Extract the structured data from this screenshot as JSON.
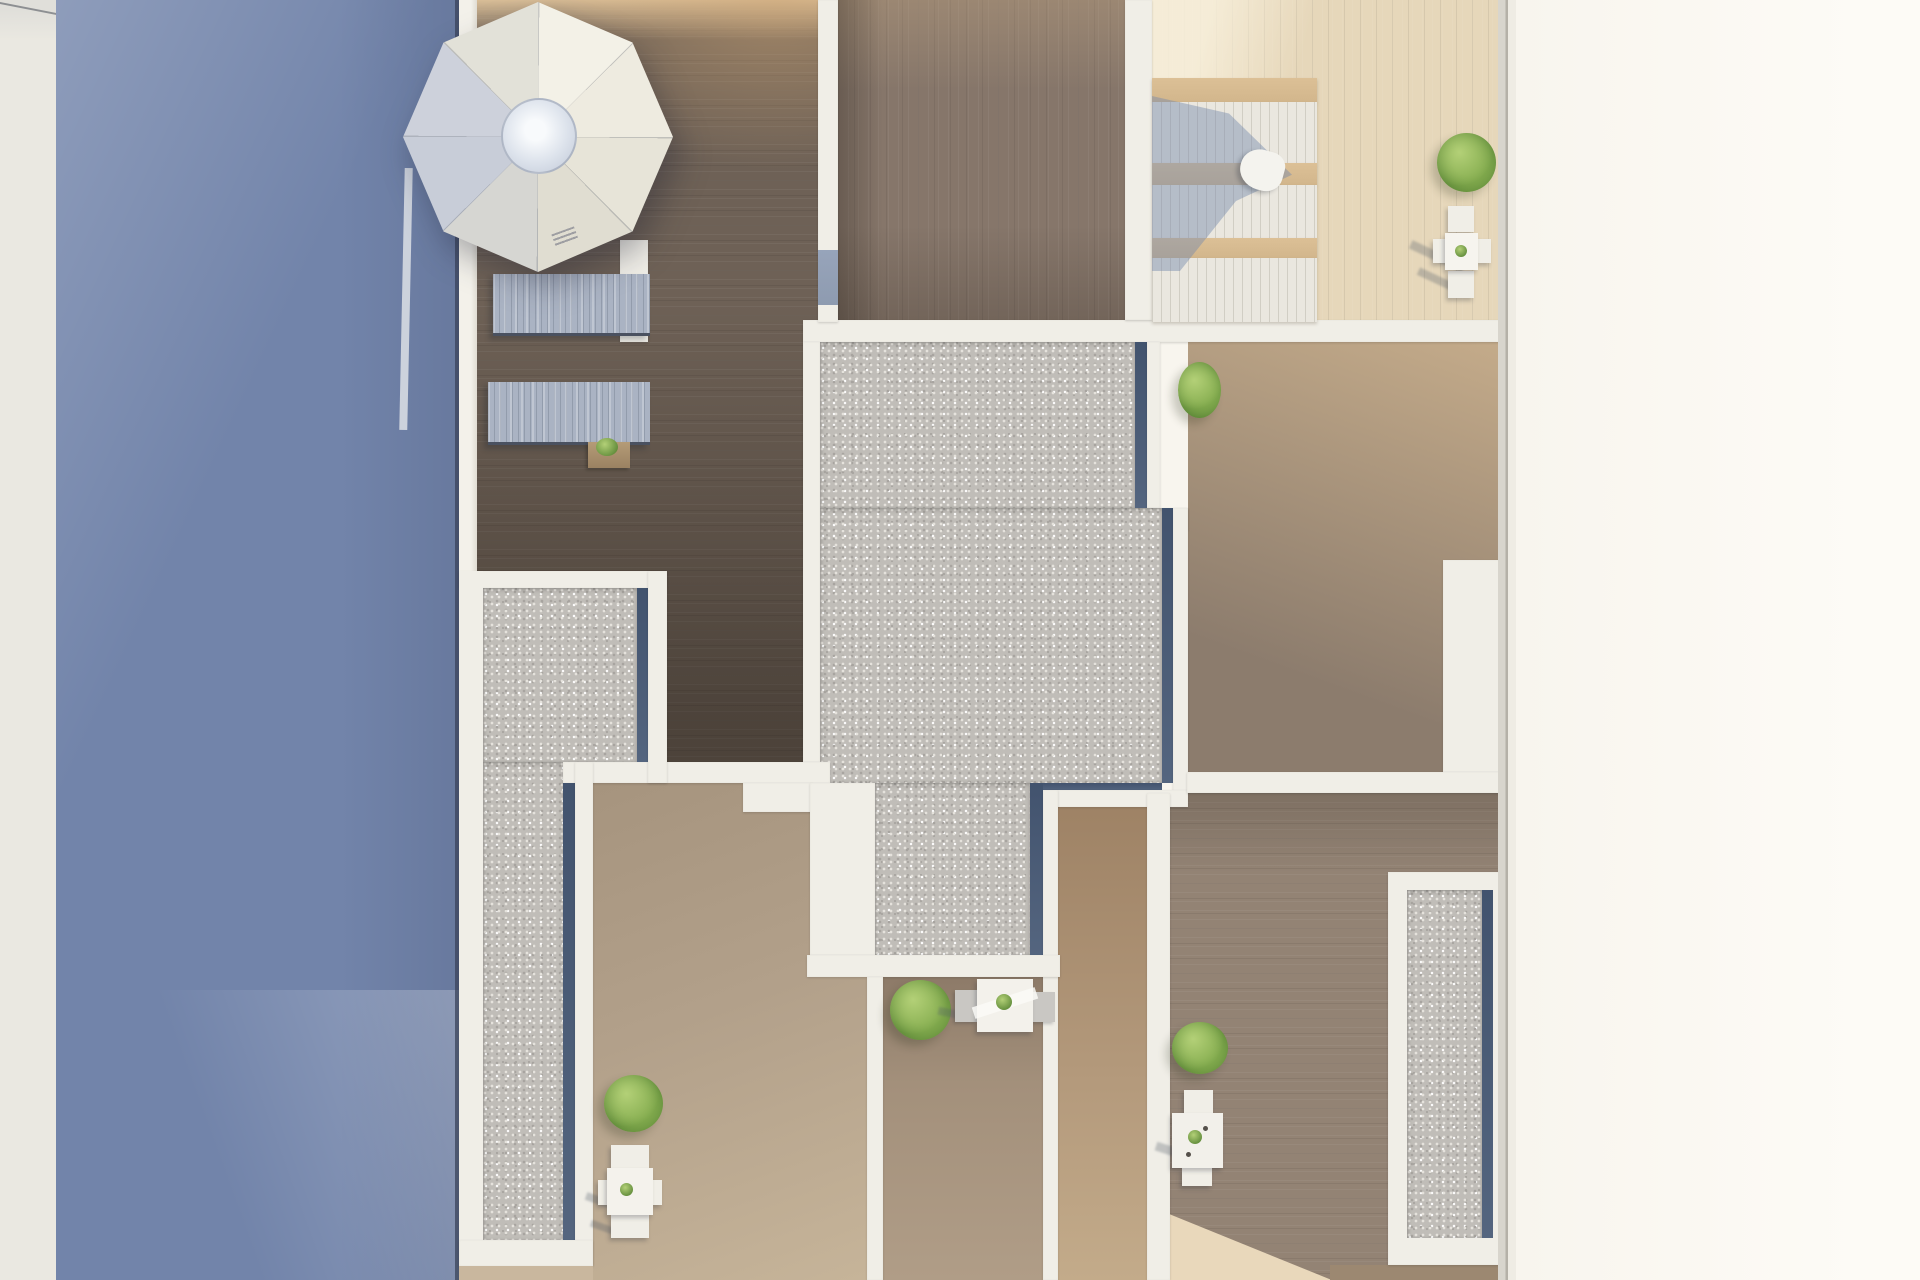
{
  "scene": {
    "title": "Aerial 3D render of rooftop terraces beside a pool",
    "type": "architectural-render",
    "view": "top-down"
  },
  "palette": {
    "pool": "#7284aa",
    "poolDeep": "#68799e",
    "marginLeft": "#eae8e1",
    "marginRight": "#f8f5ee",
    "white": "#f0eee7",
    "whiteDim": "#e4e1d8",
    "navy": "#42536e",
    "gravel": "#c0bdb8",
    "gravelDot": "#e6e3dd",
    "gravelDark": "#a7a49f",
    "woodA": "#6e6156",
    "woodSun": "#d8bd97",
    "woodB": "#86766a",
    "woodC": "#e6d7ba",
    "woodD": "#b19878",
    "woodDdark": "#8c7c6d",
    "woodE": "#938374",
    "woodF": "#b2a08a",
    "woodH": "#a3907b",
    "woodI": "#b49a7c",
    "beam": "#d2b68c",
    "lounger": "#aab3c3",
    "cpanel": "#eae7df",
    "plantLight": "#b3d077",
    "plantMid": "#85ad4f",
    "plantDark": "#5f8a39",
    "glass": "#8e9bb0",
    "edgeDark": "#39435a",
    "sunPatch": "#e9d8bb"
  },
  "labels": {
    "pool": "swimming pool water",
    "pool_wall": "white pool-side wall",
    "margin_left": "cream border strip (left)",
    "margin_right": "cream border strip (right)",
    "deck_a": "upper-left wood terrace",
    "deck_b": "upper-middle wood terrace",
    "deck_c": "upper-right sunlit wood terrace",
    "deck_d": "middle-right wood terrace",
    "deck_e": "lower-right wood terrace",
    "deck_f": "lower-left wood terrace",
    "deck_h": "lower-middle wood terrace",
    "deck_i": "wood walkway strip",
    "parasol": "white octagonal parasol",
    "parasol_hub": "parasol centre hub",
    "lounger": "sun lounger with pale blue cushion",
    "slat_lounger": "white slatted lounger row",
    "gravel_center": "central gravel roof bed",
    "gravel_left": "left gravel strip bed",
    "gravel_right": "right gravel strip bed",
    "plant": "green shrub in planter",
    "table_set": "white outdoor table with chairs",
    "wall": "white dividing wall",
    "glass_panel": "glass panel in wall",
    "planter_box": "wooden planter box",
    "towel": "white towel on lounger",
    "sun_patch": "sunlit patch on decking"
  }
}
